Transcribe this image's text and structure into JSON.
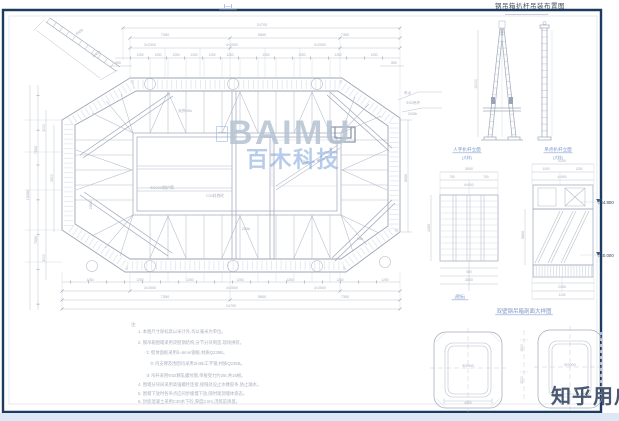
{
  "sheet": {
    "title": "钢吊箱扒杆吊装布置图",
    "section_label": "Ⅰ—Ⅰ"
  },
  "watermark": {
    "brand": "BAIMU",
    "brand_sub": "百木科技"
  },
  "user_watermark": {
    "text": "知乎用户"
  },
  "colors": {
    "border_navy": "#1d3a5f",
    "cad_line": "#aeb6c4",
    "dim_text": "#a7aebc",
    "blue_label": "#7b97c9",
    "brand": "#b6c2d3",
    "brand_sub": "#7da4dc",
    "user_text": "#4a5871",
    "bottom_strip": "#dce8f6"
  },
  "annotations": [
    {
      "x": 228,
      "y": 8,
      "t": "Ⅰ—Ⅰ",
      "c": "b",
      "s": 5.5,
      "u": 1
    },
    {
      "x": 262,
      "y": 26,
      "t": "24700"
    },
    {
      "x": 165,
      "y": 36,
      "t": "7350"
    },
    {
      "x": 262,
      "y": 36,
      "t": "5800"
    },
    {
      "x": 345,
      "y": 36,
      "t": "7350"
    },
    {
      "x": 150,
      "y": 46,
      "t": "3×2500",
      "s": 3.6
    },
    {
      "x": 232,
      "y": 46,
      "t": "4×2500",
      "s": 3.6
    },
    {
      "x": 320,
      "y": 46,
      "t": "3×2500",
      "s": 3.6
    },
    {
      "x": 140,
      "y": 56,
      "t": "1250",
      "s": 3.2
    },
    {
      "x": 158,
      "y": 56,
      "t": "1250",
      "s": 3.2
    },
    {
      "x": 176,
      "y": 56,
      "t": "1250",
      "s": 3.2
    },
    {
      "x": 194,
      "y": 56,
      "t": "1250",
      "s": 3.2
    },
    {
      "x": 212,
      "y": 56,
      "t": "1250",
      "s": 3.2
    },
    {
      "x": 230,
      "y": 56,
      "t": "1250",
      "s": 3.2
    },
    {
      "x": 266,
      "y": 56,
      "t": "1250",
      "s": 3.2
    },
    {
      "x": 302,
      "y": 56,
      "t": "1250",
      "s": 3.2
    },
    {
      "x": 338,
      "y": 56,
      "t": "1250",
      "s": 3.2
    },
    {
      "x": 374,
      "y": 56,
      "t": "1250",
      "s": 3.2
    },
    {
      "x": 118,
      "y": 64,
      "t": "850",
      "s": 3.4
    },
    {
      "x": 394,
      "y": 64,
      "t": "850",
      "s": 3.4
    },
    {
      "x": 80,
      "y": 33,
      "t": "4500",
      "r": -35
    },
    {
      "x": 97,
      "y": 55,
      "t": "2Ⅰ45b",
      "r": -35,
      "s": 3.6
    },
    {
      "x": 29,
      "y": 195,
      "t": "15000",
      "r": -90
    },
    {
      "x": 37,
      "y": 150,
      "t": "7500",
      "r": -90
    },
    {
      "x": 37,
      "y": 240,
      "t": "7500",
      "r": -90
    },
    {
      "x": 45,
      "y": 128,
      "t": "3000",
      "r": -90,
      "s": 3.4
    },
    {
      "x": 45,
      "y": 258,
      "t": "3000",
      "r": -90,
      "s": 3.4
    },
    {
      "x": 53,
      "y": 178,
      "t": "2500",
      "r": -90,
      "s": 3.4
    },
    {
      "x": 404,
      "y": 94,
      "t": "吊点",
      "s": 3.6,
      "a": "s"
    },
    {
      "x": 406,
      "y": 104,
      "t": "Φ32吊杆",
      "s": 3.6,
      "a": "s"
    },
    {
      "x": 408,
      "y": 115,
      "t": "2Ⅰ45b",
      "s": 3.6,
      "a": "s"
    },
    {
      "x": 407,
      "y": 178,
      "t": "8000",
      "r": -90,
      "s": 3.6
    },
    {
      "x": 162,
      "y": 189,
      "t": "Φ2000钢护筒",
      "s": 4
    },
    {
      "x": 215,
      "y": 197,
      "t": "C30封底砼",
      "s": 3.8
    },
    {
      "x": 246,
      "y": 230,
      "t": "2Ⅰ45b",
      "s": 3.4
    },
    {
      "x": 305,
      "y": 163,
      "t": "2Ⅰ56b",
      "s": 3.4
    },
    {
      "x": 185,
      "y": 112,
      "t": "双拼Ⅰ45b",
      "s": 3.4
    },
    {
      "x": 92,
      "y": 205,
      "t": "2Ⅰ45b",
      "s": 3.4,
      "r": -90
    },
    {
      "x": 360,
      "y": 240,
      "t": "Ⅰ45b",
      "s": 3.4
    },
    {
      "x": 90,
      "y": 281,
      "t": "1250",
      "s": 3.2
    },
    {
      "x": 140,
      "y": 281,
      "t": "1250",
      "s": 3.2
    },
    {
      "x": 190,
      "y": 281,
      "t": "1250",
      "s": 3.2
    },
    {
      "x": 240,
      "y": 281,
      "t": "1250",
      "s": 3.2
    },
    {
      "x": 290,
      "y": 281,
      "t": "1250",
      "s": 3.2
    },
    {
      "x": 340,
      "y": 281,
      "t": "1250",
      "s": 3.2
    },
    {
      "x": 385,
      "y": 281,
      "t": "1250",
      "s": 3.2
    },
    {
      "x": 150,
      "y": 289,
      "t": "3×2500",
      "s": 3.6
    },
    {
      "x": 232,
      "y": 289,
      "t": "4×2500",
      "s": 3.6
    },
    {
      "x": 320,
      "y": 289,
      "t": "3×2500",
      "s": 3.6
    },
    {
      "x": 165,
      "y": 298,
      "t": "7350"
    },
    {
      "x": 262,
      "y": 298,
      "t": "5800"
    },
    {
      "x": 345,
      "y": 298,
      "t": "7350"
    },
    {
      "x": 231,
      "y": 307,
      "t": "24700"
    },
    {
      "x": 477,
      "y": 84,
      "t": "12000",
      "r": -90,
      "s": 3.4
    },
    {
      "x": 467,
      "y": 151,
      "t": "人字扒杆立面",
      "c": "b",
      "s": 4.6,
      "u": 1
    },
    {
      "x": 467,
      "y": 159,
      "t": "(大样)",
      "c": "b",
      "s": 3.8
    },
    {
      "x": 558,
      "y": 151,
      "t": "吊点扒杆立面",
      "c": "b",
      "s": 4.6,
      "u": 1
    },
    {
      "x": 558,
      "y": 159,
      "t": "(大样)",
      "c": "b",
      "s": 3.8
    },
    {
      "x": 469,
      "y": 170,
      "t": "3000",
      "s": 3.6
    },
    {
      "x": 452,
      "y": 178,
      "t": "750",
      "s": 3.2
    },
    {
      "x": 486,
      "y": 178,
      "t": "750",
      "s": 3.2
    },
    {
      "x": 469,
      "y": 186,
      "t": "6×500",
      "s": 3.2
    },
    {
      "x": 430,
      "y": 228,
      "t": "4200",
      "r": -90,
      "s": 3.6
    },
    {
      "x": 469,
      "y": 273,
      "t": "500",
      "s": 3.2
    },
    {
      "x": 469,
      "y": 281,
      "t": "3000",
      "s": 3.6
    },
    {
      "x": 460,
      "y": 298,
      "t": "(壁板)",
      "c": "b",
      "s": 4,
      "u": 1
    },
    {
      "x": 562,
      "y": 162,
      "t": "2250",
      "s": 3.6
    },
    {
      "x": 546,
      "y": 170,
      "t": "1000",
      "s": 3.2
    },
    {
      "x": 579,
      "y": 170,
      "t": "1250",
      "s": 3.2
    },
    {
      "x": 562,
      "y": 178,
      "t": "4×550",
      "s": 3.2
    },
    {
      "x": 524,
      "y": 235,
      "t": "5600",
      "r": -90,
      "s": 3.6
    },
    {
      "x": 562,
      "y": 288,
      "t": "2250",
      "s": 3.6
    },
    {
      "x": 562,
      "y": 296,
      "t": "1125",
      "s": 3.2
    },
    {
      "x": 597,
      "y": 204,
      "t": "▽44.800",
      "c": "n",
      "s": 4.4,
      "a": "s"
    },
    {
      "x": 597,
      "y": 257,
      "t": "▽40.000",
      "c": "n",
      "s": 4.4,
      "a": "s"
    },
    {
      "x": 524,
      "y": 313,
      "t": "双壁钢吊箱剖面大样图",
      "c": "b",
      "s": 5.5,
      "u": 1
    },
    {
      "x": 468,
      "y": 367,
      "t": "Φ2500",
      "s": 3.8
    },
    {
      "x": 570,
      "y": 366,
      "t": "Φ2500",
      "s": 3.8
    },
    {
      "x": 523,
      "y": 348,
      "t": "1500",
      "r": -90,
      "s": 3.4
    },
    {
      "x": 523,
      "y": 380,
      "t": "2200",
      "r": -90,
      "s": 3.4
    },
    {
      "x": 468,
      "y": 404,
      "t": "4000",
      "s": 3.4
    },
    {
      "x": 131,
      "y": 326,
      "t": "注:",
      "c": "note",
      "s": 4.3,
      "a": "s"
    },
    {
      "x": 138,
      "y": 333,
      "t": "1. 本图尺寸除标高以米计外,均以毫米为单位。",
      "c": "note",
      "s": 4.3,
      "a": "s"
    },
    {
      "x": 138,
      "y": 344,
      "t": "2. 钢吊箱围堰采用双壁钢结构,分节分块制造,现场拼装。",
      "c": "note",
      "s": 4.3,
      "a": "s"
    },
    {
      "x": 146,
      "y": 354,
      "t": "① 壁体面板采用δ=6mm钢板,材质Q235B。",
      "c": "note",
      "s": 4.3,
      "a": "s"
    },
    {
      "x": 150,
      "y": 365,
      "t": "② 内支撑及围囹均采用2Ⅰ45b工字钢,材质Q235B。",
      "c": "note",
      "s": 4.3,
      "a": "s"
    },
    {
      "x": 146,
      "y": 377,
      "t": "③ 吊杆采用Φ32精轧螺纹钢,单根受力约25t,共16根。",
      "c": "note",
      "s": 4.3,
      "a": "s"
    },
    {
      "x": 138,
      "y": 386,
      "t": "4. 围堰分块间采用高强螺栓连接,接缝处设止水橡胶条,防止漏水。",
      "c": "note",
      "s": 4.3,
      "a": "s"
    },
    {
      "x": 138,
      "y": 395,
      "t": "5. 围堰下放时各吊点应同步缓慢下放,随时观测堰体姿态。",
      "c": "note",
      "s": 4.3,
      "a": "s"
    },
    {
      "x": 138,
      "y": 403,
      "t": "6. 封底混凝土采用C30水下砼,厚度2.0m,浇筑前清基。",
      "c": "note",
      "s": 4.3,
      "a": "s"
    }
  ]
}
